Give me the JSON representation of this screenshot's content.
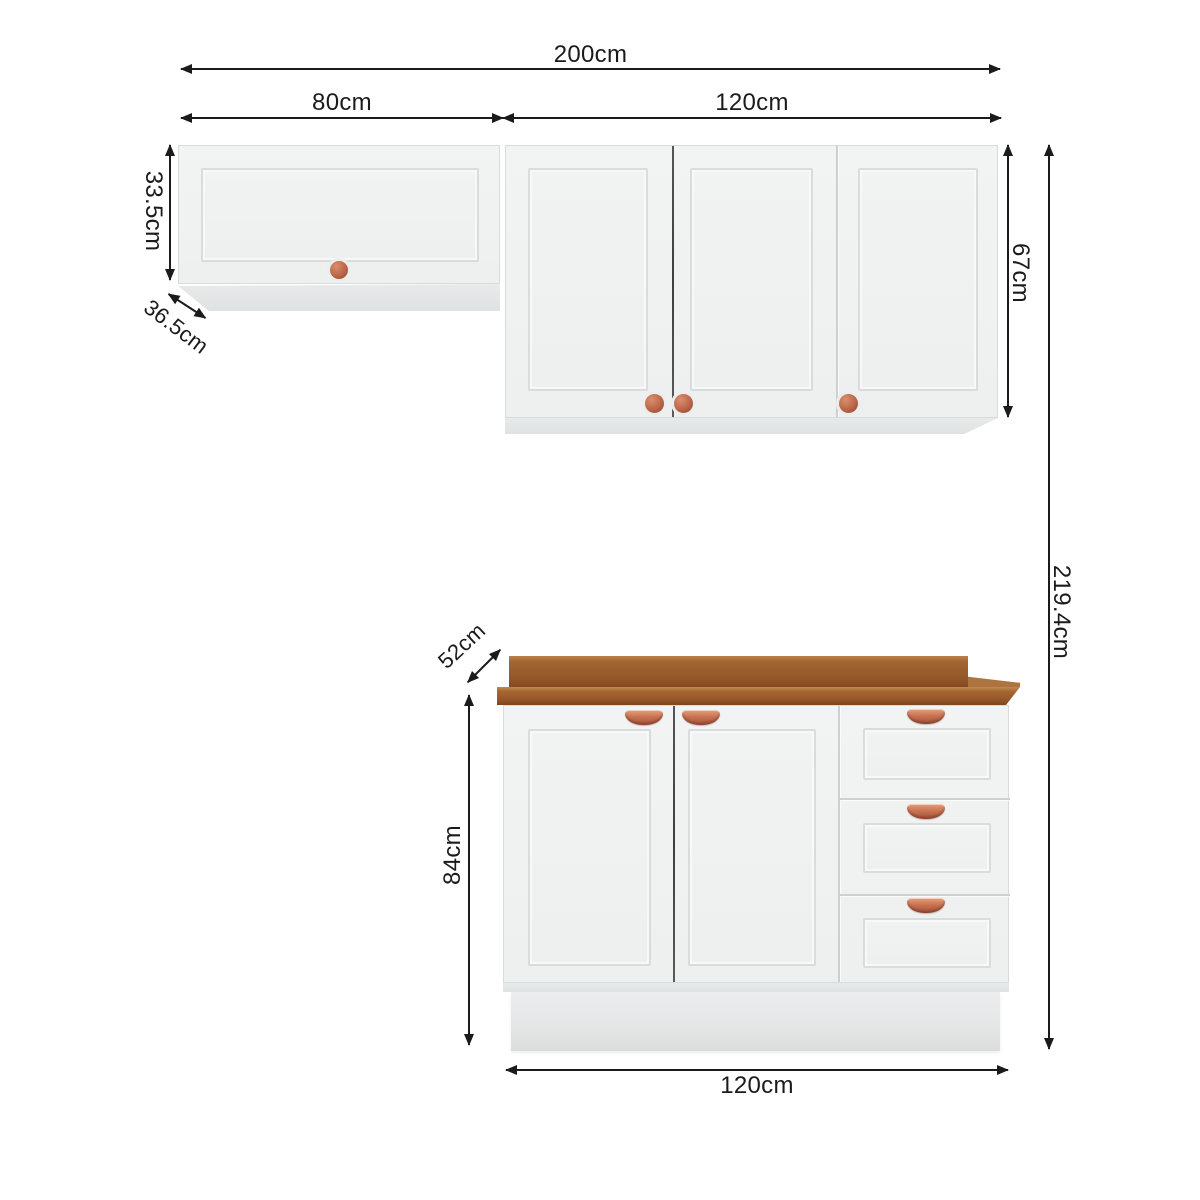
{
  "dimensions": {
    "total_width": "200cm",
    "wall_left_width": "80cm",
    "wall_right_width": "120cm",
    "wall_left_height": "33.5cm",
    "wall_left_depth": "36.5cm",
    "wall_right_height": "67cm",
    "total_height": "219.4cm",
    "counter_depth": "52cm",
    "base_height": "84cm",
    "base_width": "120cm"
  },
  "colors": {
    "background": "#ffffff",
    "dimension_line": "#1b1b1b",
    "cabinet_body": "#f0f2f2",
    "countertop_brown": "#9a5c2a",
    "handle_copper": "#c97453"
  }
}
